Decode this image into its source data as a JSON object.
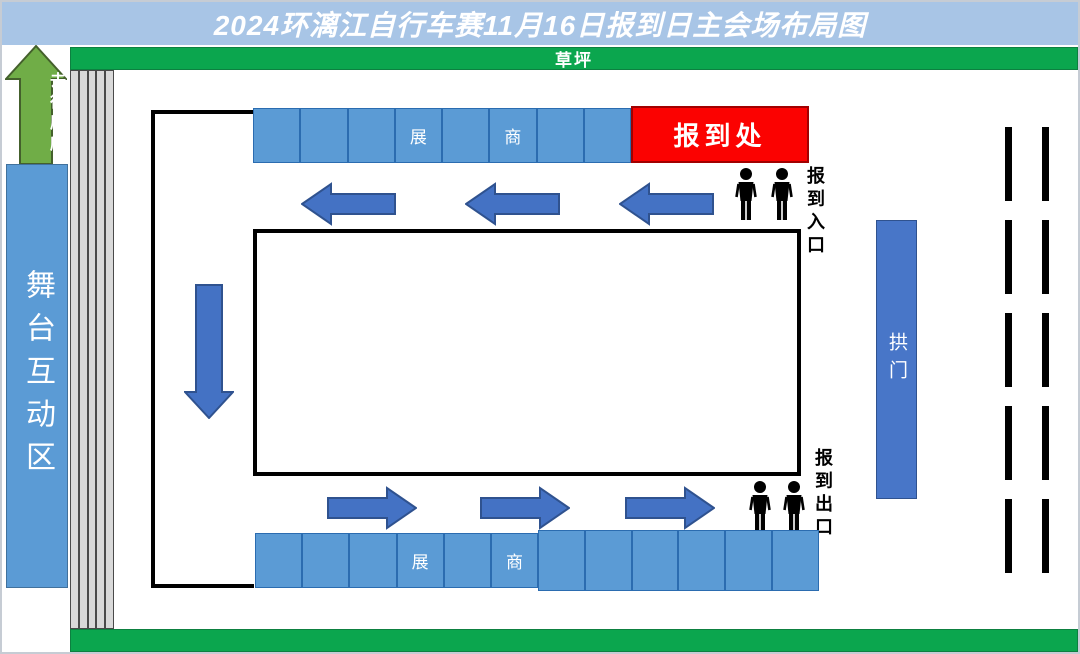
{
  "title": "2024环漓江自行车赛11月16日报到日主会场布局图",
  "lawn": {
    "label": "草坪"
  },
  "toilet_arrow": {
    "label": "去往厕所"
  },
  "stage": {
    "label": "舞台互动区"
  },
  "registration_desk": {
    "label": "报到处"
  },
  "entrance": {
    "label": "报到入口",
    "person_count": 2
  },
  "exit": {
    "label": "报到出口",
    "person_count": 2
  },
  "arch": {
    "label": "拱门"
  },
  "booths": {
    "top_cells": [
      "",
      "",
      "",
      "展",
      "",
      "商",
      "",
      ""
    ],
    "bottom_cells_left": [
      "",
      "",
      "",
      "展",
      "",
      "商"
    ],
    "bottom_cells_right": [
      "",
      "",
      "",
      "",
      "",
      ""
    ]
  },
  "flow": {
    "top_arrows": 3,
    "top_direction": "left",
    "bottom_arrows": 3,
    "bottom_direction": "right",
    "side_arrows": 1,
    "side_direction": "down"
  },
  "colors": {
    "titlebar": "#a8c5e6",
    "lawn": "#0ba64e",
    "booth": "#5b9bd5",
    "reg": "#fb0201",
    "arrow": "#4472c4",
    "arch": "#4876c8",
    "stage": "#5b9bd5",
    "toilet": "#70ad47"
  }
}
